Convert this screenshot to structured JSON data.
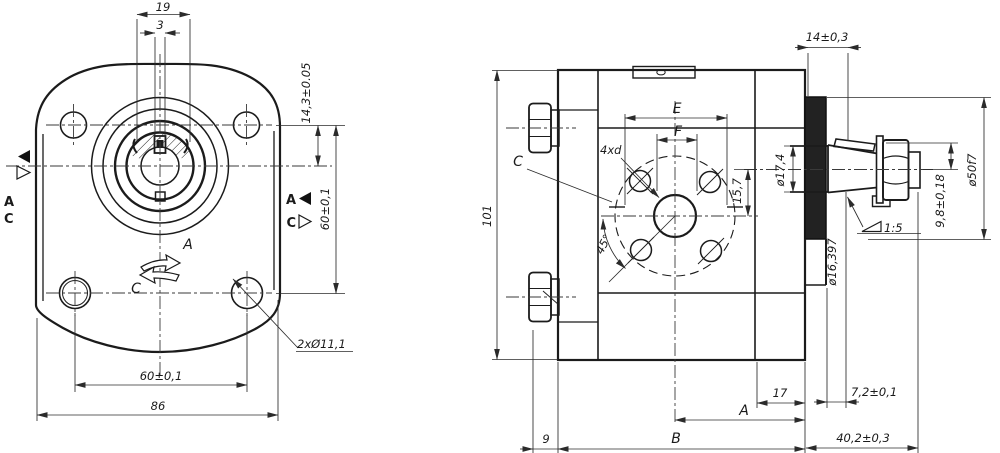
{
  "drawing": {
    "front_view": {
      "dim_width_key": "19",
      "dim_key_slot": "3",
      "dim_shaft_offset": "14,3±0.05",
      "dim_hole_spacing_v": "60±0,1",
      "dim_hole_spacing_h": "60±0,1",
      "dim_overall_width": "86",
      "label_holes": "2xØ11,1",
      "rotation_cw_label": "A",
      "rotation_ccw_label": "C",
      "port_left_a": "A",
      "port_left_c": "C",
      "port_right_a": "A",
      "port_right_c": "C"
    },
    "side_view": {
      "dim_overall_height": "101",
      "view_label_c": "C",
      "label_bolt_holes": "4xd",
      "dim_e": "E",
      "dim_f": "F",
      "dim_port_offset": "15,7",
      "dim_angle": "45°",
      "dim_shaft_dia": "ø17,4",
      "dim_flange_thickness": "14±0,3",
      "dim_nut_height": "9,8±0,18",
      "dim_pilot_dia": "ø50f7",
      "dim_taper_gauge_dia": "ø16,397",
      "taper_ratio": "1:5",
      "dim_gauge_plane": "7,2±0,1",
      "dim_front_cover": "17",
      "dim_a_label": "A",
      "dim_b_label": "B",
      "dim_rear_cover": "9",
      "dim_shaft_length": "40,2±0,3"
    }
  }
}
